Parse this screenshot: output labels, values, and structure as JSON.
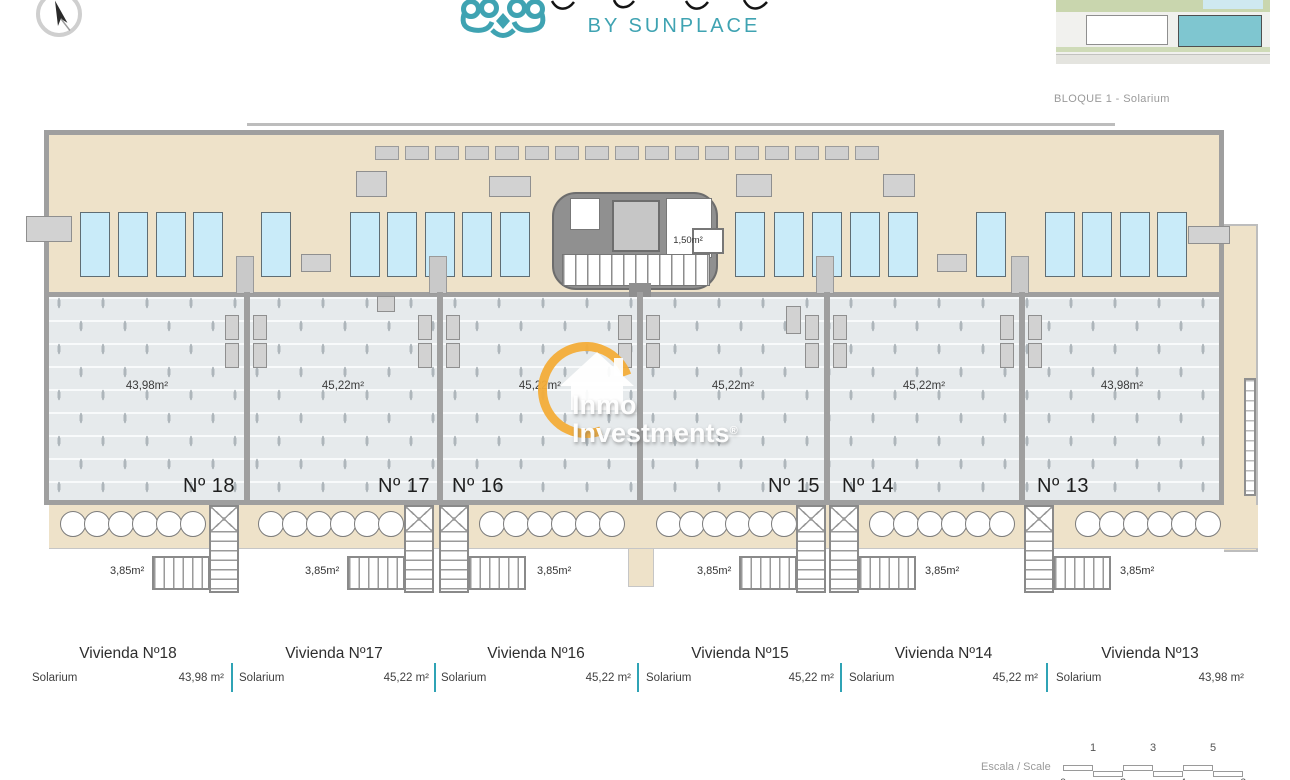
{
  "logo": {
    "byline": "BY SUNPLACE",
    "brand_color": "#3FA3B2"
  },
  "site_plan": {
    "caption": "BLOQUE 1 - Solarium",
    "highlight_color": "#7fc6d0"
  },
  "core": {
    "area_label": "1,50m²"
  },
  "watermark": {
    "line1": "Inmo",
    "line2": "Investments",
    "reg": "®",
    "ring_color": "#F4AD39"
  },
  "units": [
    {
      "id": "18",
      "number_label": "Nº 18",
      "area_label": "43,98m²",
      "stair_area_label": "3,85m²",
      "table_header": "Vivienda Nº18",
      "table_row_label": "Solarium",
      "table_row_value": "43,98 m²"
    },
    {
      "id": "17",
      "number_label": "Nº 17",
      "area_label": "45,22m²",
      "stair_area_label": "3,85m²",
      "table_header": "Vivienda Nº17",
      "table_row_label": "Solarium",
      "table_row_value": "45,22 m²"
    },
    {
      "id": "16",
      "number_label": "Nº 16",
      "area_label": "45,22m²",
      "stair_area_label": "3,85m²",
      "table_header": "Vivienda Nº16",
      "table_row_label": "Solarium",
      "table_row_value": "45,22 m²"
    },
    {
      "id": "15",
      "number_label": "Nº 15",
      "area_label": "45,22m²",
      "stair_area_label": "3,85m²",
      "table_header": "Vivienda Nº15",
      "table_row_label": "Solarium",
      "table_row_value": "45,22 m²"
    },
    {
      "id": "14",
      "number_label": "Nº 14",
      "area_label": "45,22m²",
      "stair_area_label": "3,85m²",
      "table_header": "Vivienda Nº14",
      "table_row_label": "Solarium",
      "table_row_value": "45,22 m²"
    },
    {
      "id": "13",
      "number_label": "Nº 13",
      "area_label": "43,98m²",
      "stair_area_label": "3,85m²",
      "table_header": "Vivienda Nº13",
      "table_row_label": "Solarium",
      "table_row_value": "43,98 m²"
    }
  ],
  "scale": {
    "label": "Escala / Scale",
    "top_ticks": [
      "1",
      "3",
      "5"
    ],
    "bottom_ticks": [
      "0",
      "2",
      "4",
      "6"
    ]
  },
  "colors": {
    "terrace_beige": "#EEE2C9",
    "solarium_floor": "#E6EAEC",
    "wall_gray": "#9f9f9f",
    "sunbed_blue": "#C9EBF9",
    "brand_teal": "#3FA3B2",
    "table_divider_teal": "#2FA3B5",
    "watermark_orange": "#F4AD39"
  }
}
